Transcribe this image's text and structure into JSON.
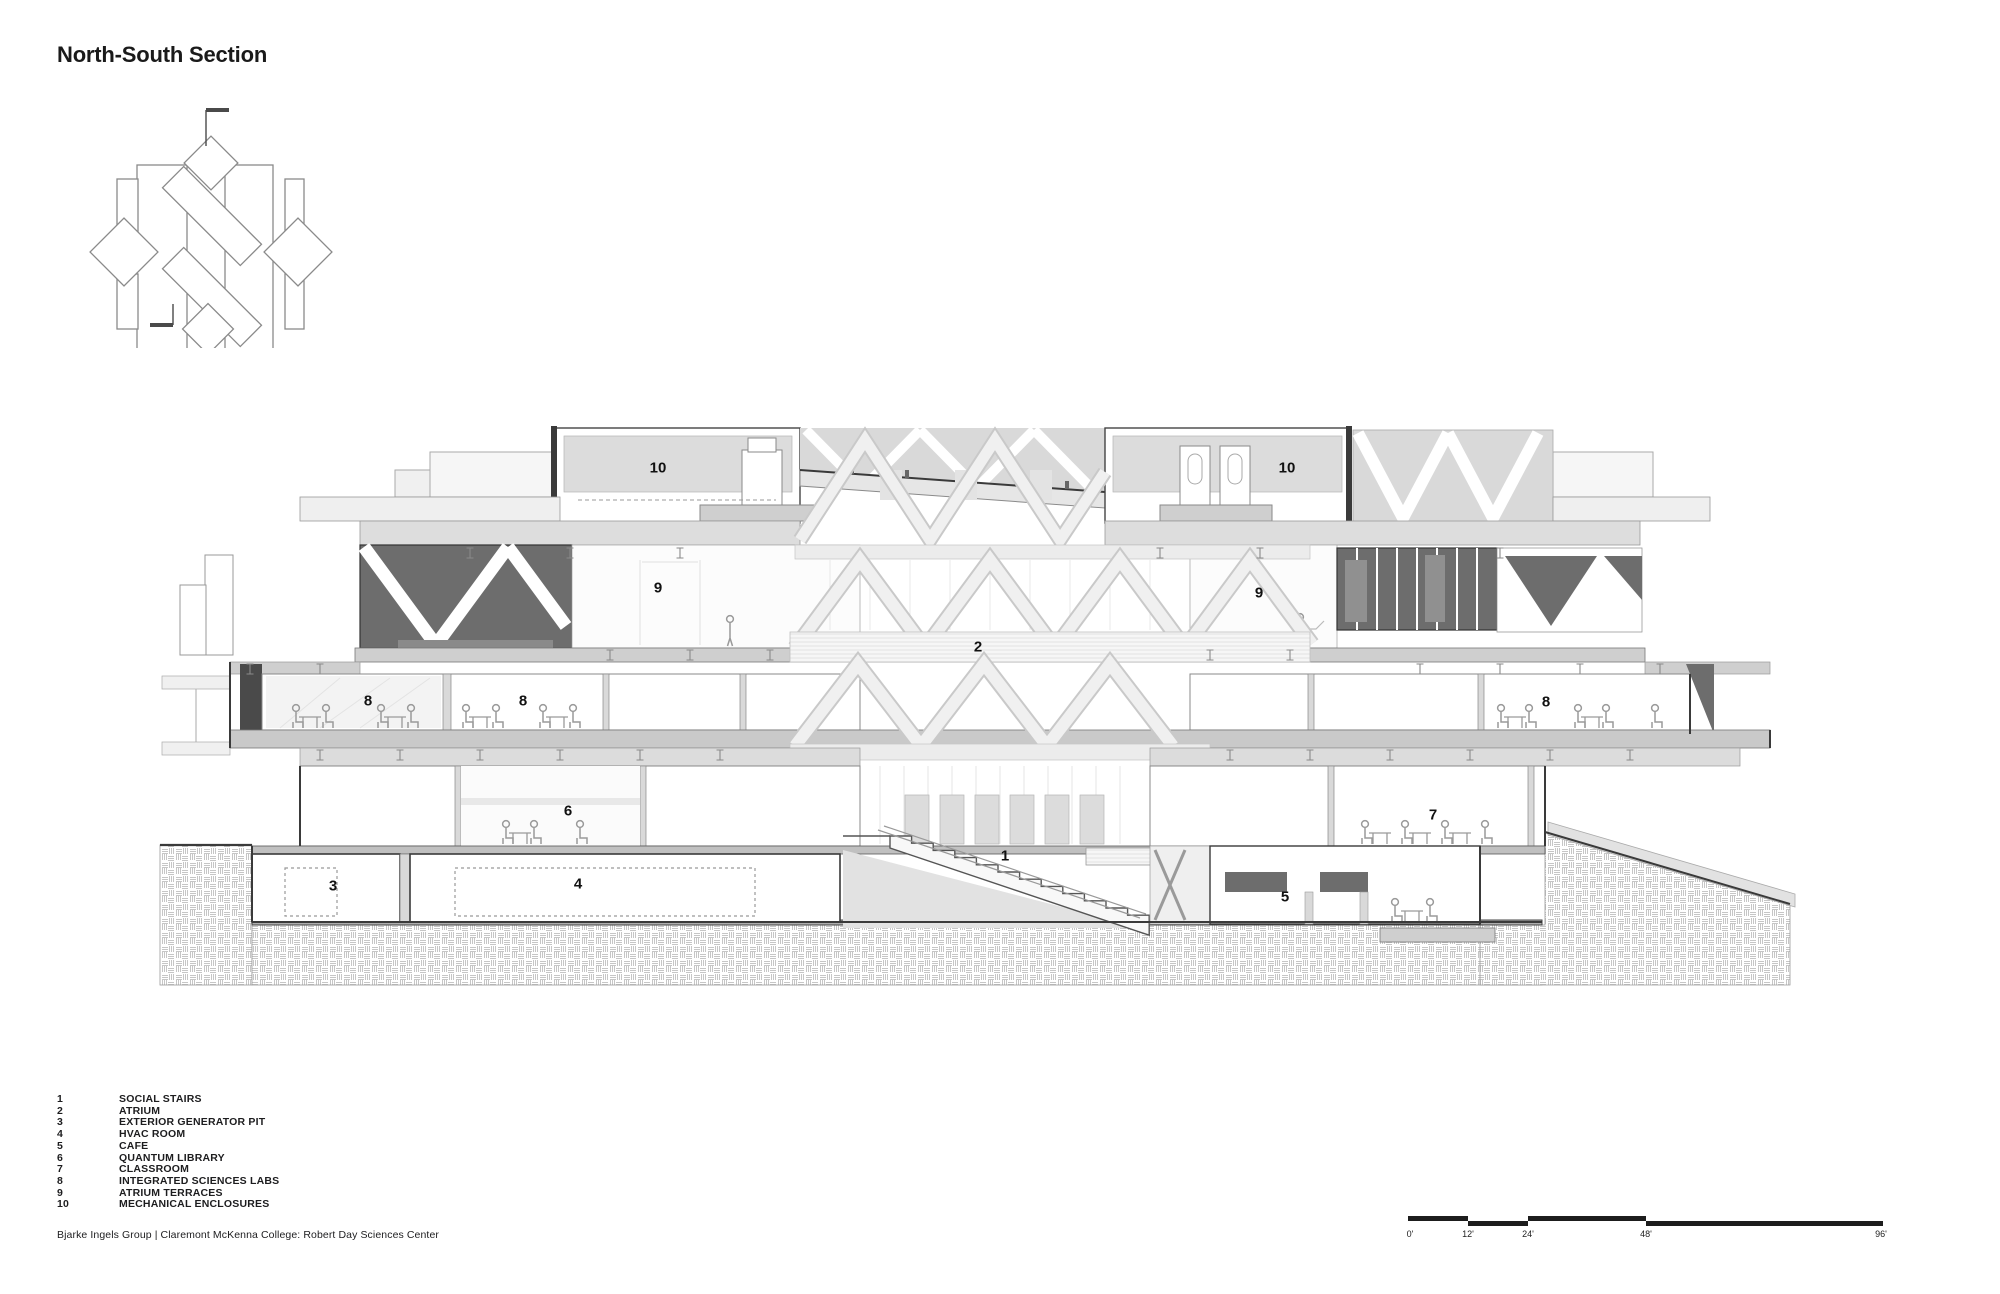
{
  "page": {
    "title": "North-South Section",
    "credit": "Bjarke Ingels Group | Claremont McKenna College: Robert Day Sciences Center"
  },
  "legend": {
    "items": [
      {
        "num": "1",
        "label": "SOCIAL STAIRS"
      },
      {
        "num": "2",
        "label": "ATRIUM"
      },
      {
        "num": "3",
        "label": "EXTERIOR GENERATOR PIT"
      },
      {
        "num": "4",
        "label": "HVAC ROOM"
      },
      {
        "num": "5",
        "label": "CAFE"
      },
      {
        "num": "6",
        "label": "QUANTUM LIBRARY"
      },
      {
        "num": "7",
        "label": "CLASSROOM"
      },
      {
        "num": "8",
        "label": "INTEGRATED SCIENCES LABS"
      },
      {
        "num": "9",
        "label": "ATRIUM TERRACES"
      },
      {
        "num": "10",
        "label": "MECHANICAL ENCLOSURES"
      }
    ]
  },
  "scale_bar": {
    "labels": [
      "0'",
      "12'",
      "24'",
      "48'",
      "96'"
    ]
  },
  "drawing": {
    "labels": [
      "10",
      "10",
      "9",
      "9",
      "2",
      "8",
      "8",
      "8",
      "6",
      "7",
      "1",
      "3",
      "4",
      "5"
    ]
  },
  "colors": {
    "ink": "#1a1a1a",
    "dark_panel": "#6d6d6d",
    "light_panel": "#dcdcdc"
  }
}
